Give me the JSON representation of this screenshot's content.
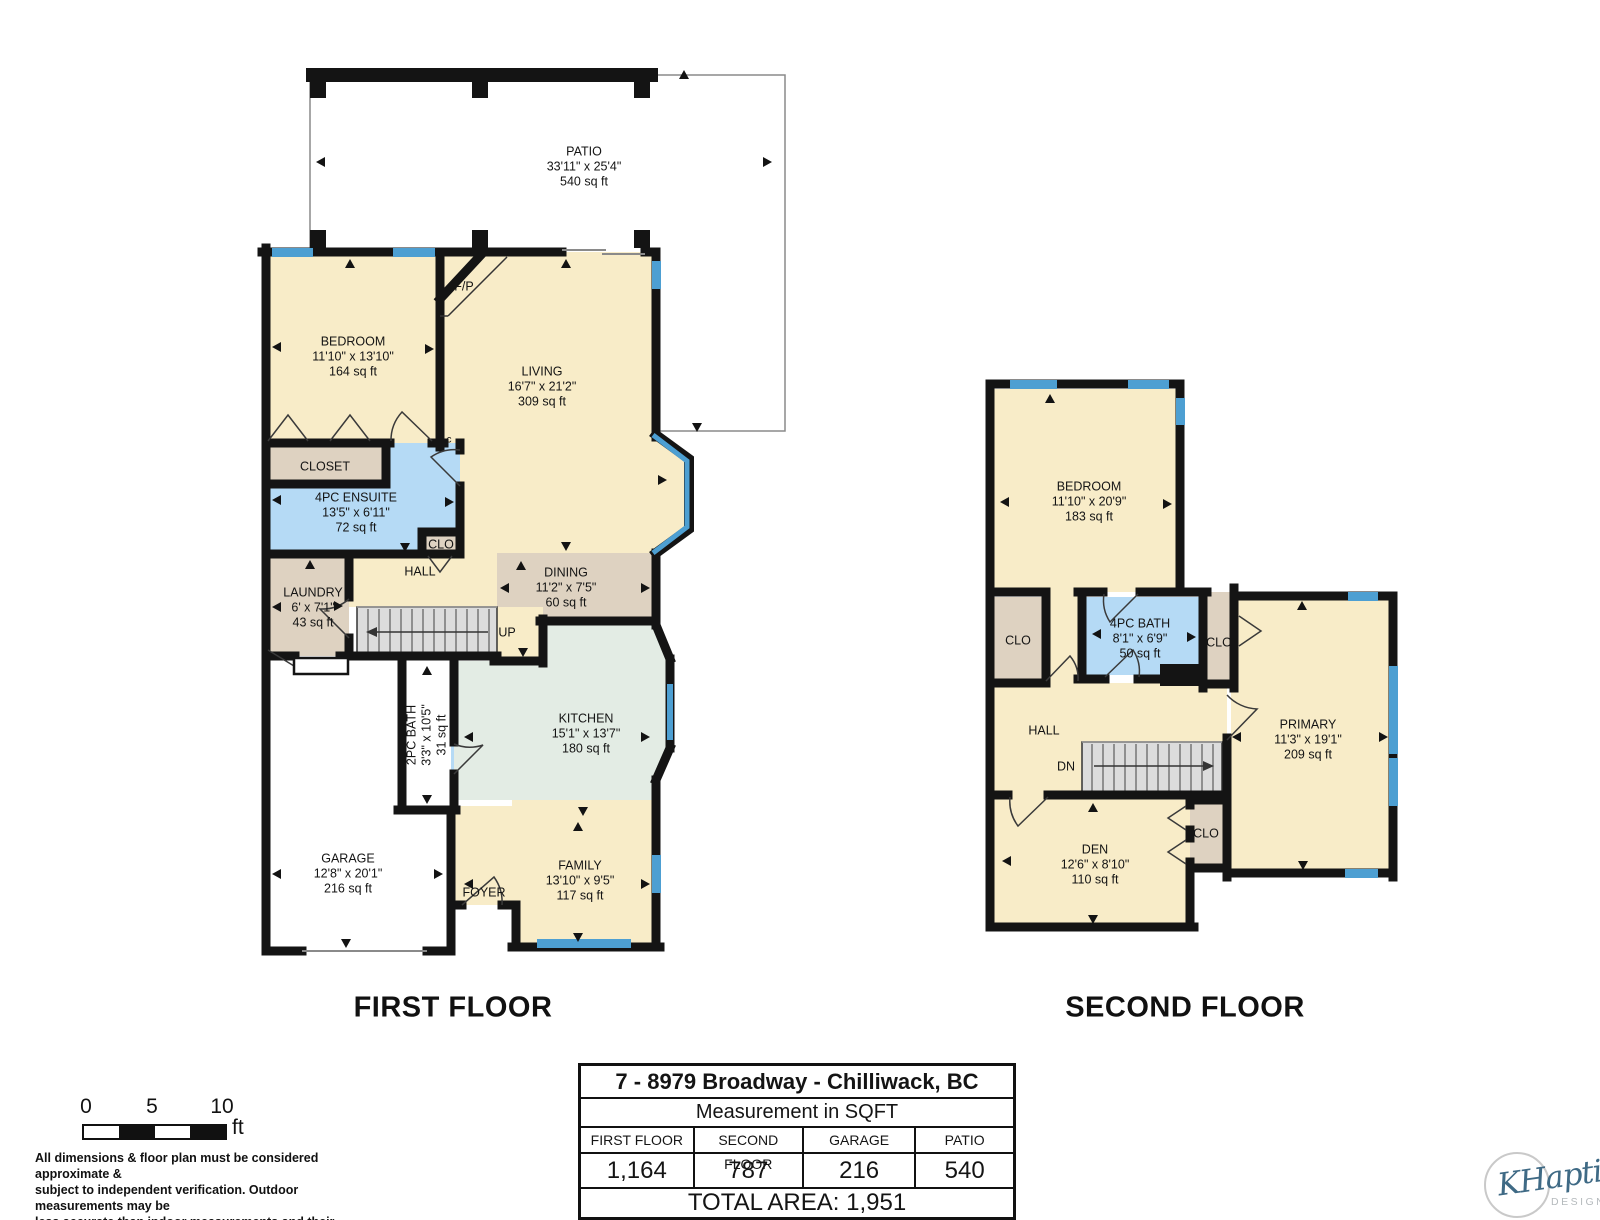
{
  "titles": {
    "first": "FIRST FLOOR",
    "second": "SECOND FLOOR"
  },
  "first_floor": {
    "patio": {
      "name": "PATIO",
      "dims": "33'11\" x 25'4\"",
      "area": "540 sq ft"
    },
    "bedroom": {
      "name": "BEDROOM",
      "dims": "11'10\" x 13'10\"",
      "area": "164 sq ft"
    },
    "living": {
      "name": "LIVING",
      "dims": "16'7\" x 21'2\"",
      "area": "309 sq ft"
    },
    "fireplace": "F/P",
    "closet": "CLOSET",
    "ensuite": {
      "name": "4PC ENSUITE",
      "dims": "13'5\" x 6'11\"",
      "area": "72 sq ft"
    },
    "clo": "CLO",
    "c_marker": "c",
    "laundry": {
      "name": "LAUNDRY",
      "dims": "6' x 7'1\"",
      "area": "43 sq ft"
    },
    "hall": "HALL",
    "up": "UP",
    "dining": {
      "name": "DINING",
      "dims": "11'2\" x 7'5\"",
      "area": "60 sq ft"
    },
    "kitchen": {
      "name": "KITCHEN",
      "dims": "15'1\" x 13'7\"",
      "area": "180 sq ft"
    },
    "bath": {
      "name": "2PC BATH",
      "dims": "3'3\" x 10'5\"",
      "area": "31 sq ft"
    },
    "garage": {
      "name": "GARAGE",
      "dims": "12'8\" x 20'1\"",
      "area": "216 sq ft"
    },
    "foyer": "FOYER",
    "family": {
      "name": "FAMILY",
      "dims": "13'10\" x 9'5\"",
      "area": "117 sq ft"
    }
  },
  "second_floor": {
    "bedroom": {
      "name": "BEDROOM",
      "dims": "11'10\" x 20'9\"",
      "area": "183 sq ft"
    },
    "clo_left": "CLO",
    "bath": {
      "name": "4PC BATH",
      "dims": "8'1\" x 6'9\"",
      "area": "50 sq ft"
    },
    "clo_right": "CLO",
    "primary": {
      "name": "PRIMARY",
      "dims": "11'3\" x 19'1\"",
      "area": "209 sq ft"
    },
    "hall": "HALL",
    "dn": "DN",
    "den": {
      "name": "DEN",
      "dims": "12'6\" x 8'10\"",
      "area": "110 sq ft"
    },
    "clo_bottom": "CLO"
  },
  "scale_bar": {
    "tick_0": "0",
    "tick_5": "5",
    "tick_10": "10",
    "unit": "ft"
  },
  "disclaimer": "All dimensions & floor plan must be considered approximate &\nsubject to independent verification.  Outdoor measurements may be\nless accurate than indoor measurements and their accuracy is not\nguaranteed.",
  "summary_table": {
    "address": "7 - 8979 Broadway - Chilliwack, BC",
    "subtitle": "Measurement in SQFT",
    "columns": [
      "FIRST FLOOR",
      "SECOND FLOOR",
      "GARAGE",
      "PATIO"
    ],
    "values": [
      "1,164",
      "787",
      "216",
      "540"
    ],
    "total": "TOTAL AREA: 1,951"
  },
  "logo": {
    "brand": "KHaptive",
    "sub": "DESIGN"
  },
  "colors": {
    "wall": "#141414",
    "room_cream": "#f8ecc8",
    "room_tan": "#ded2c1",
    "room_blue": "#b5daf5",
    "room_green": "#e3ece4",
    "window_blue": "#4d9fd2",
    "stairs_gray": "#dcdcdc"
  }
}
